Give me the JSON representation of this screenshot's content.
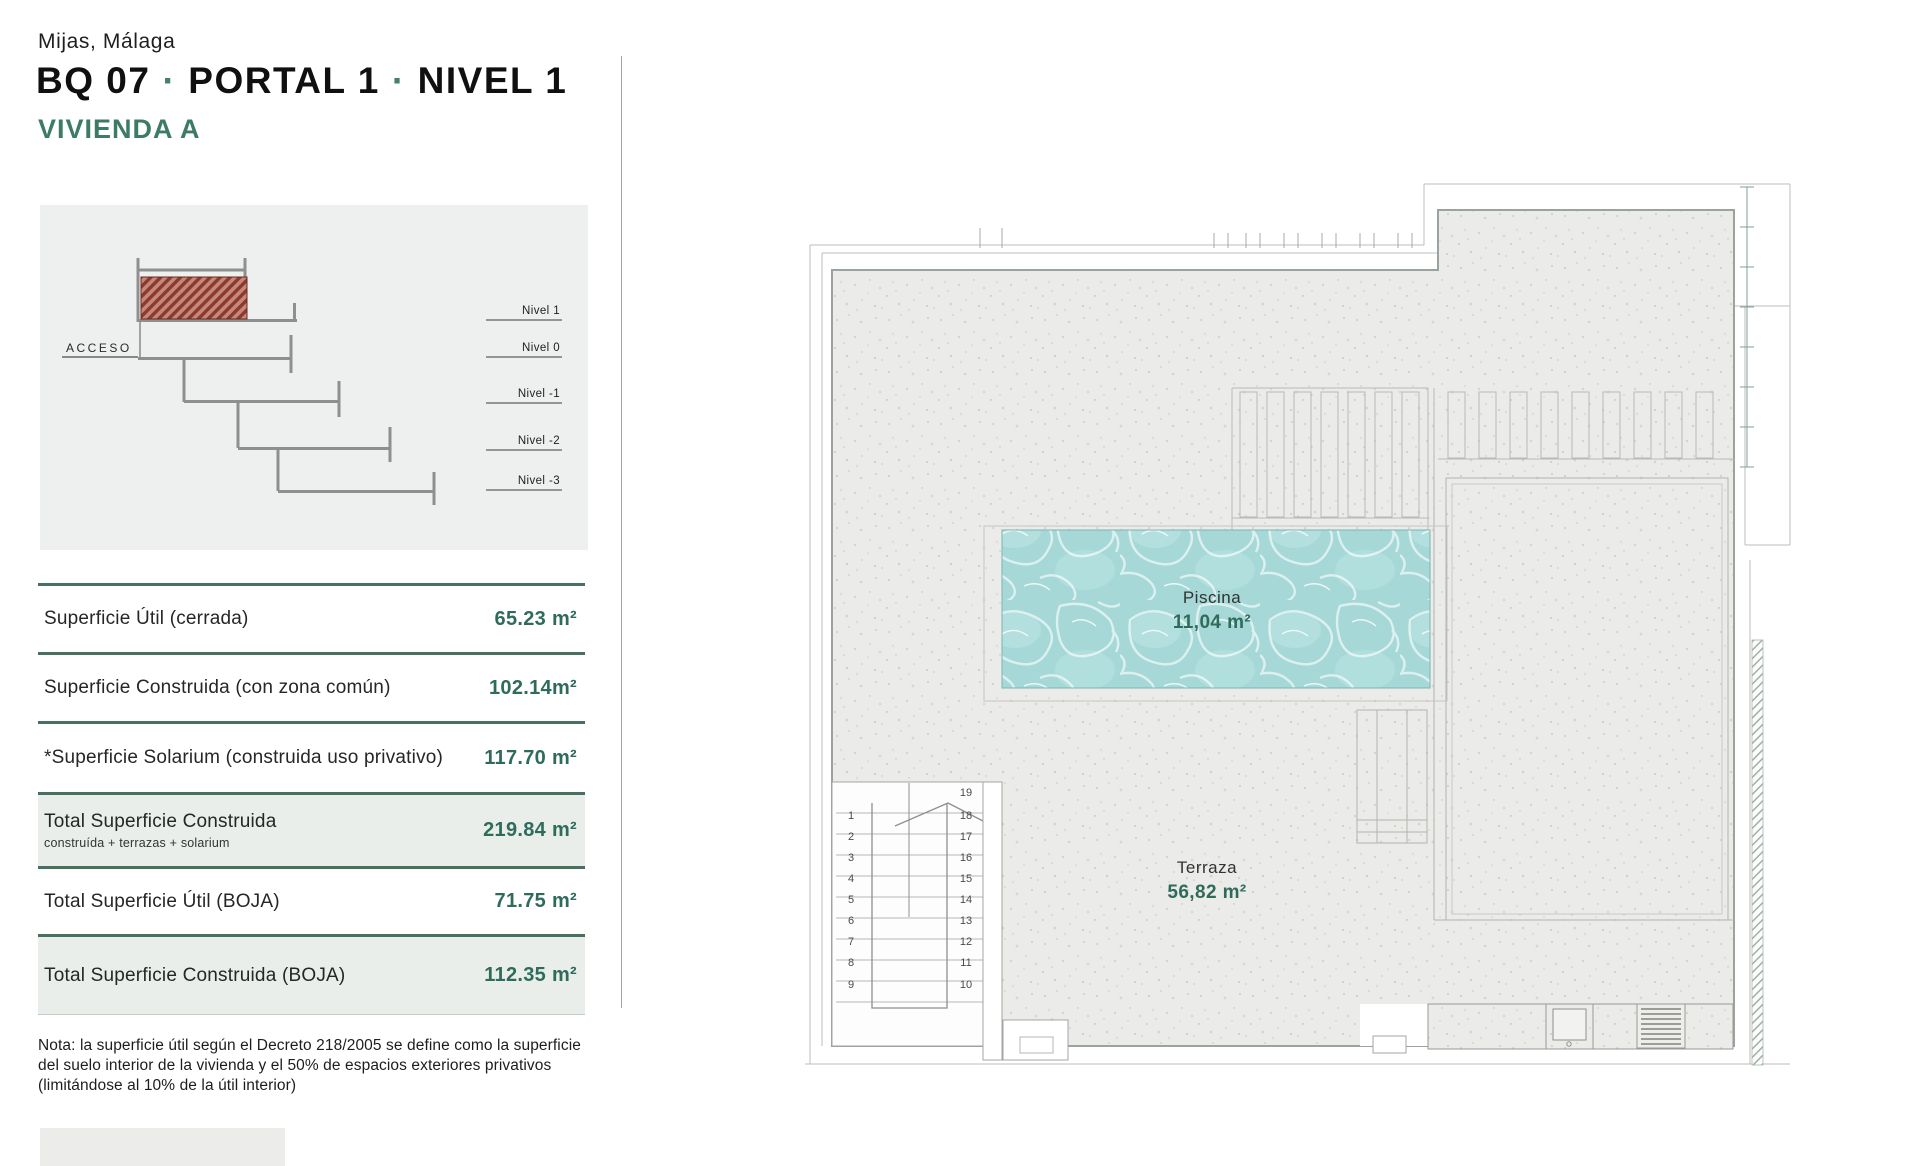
{
  "header": {
    "location": "Mijas, Málaga",
    "block": "BQ 07",
    "portal": "PORTAL 1",
    "level": "NIVEL 1",
    "separator": "·",
    "unit": "VIVIENDA A"
  },
  "section_diagram": {
    "access_label": "ACCESO",
    "levels": [
      "Nivel 1",
      "Nivel 0",
      "Nivel -1",
      "Nivel -2",
      "Nivel -3"
    ]
  },
  "areas_table": {
    "rows": [
      {
        "label": "Superficie Útil (cerrada)",
        "value": "65.23 m²"
      },
      {
        "label": "Superficie Construida (con zona común)",
        "value": "102.14m²"
      },
      {
        "label": "*Superficie Solarium (construida uso privativo)",
        "value": "117.70 m²"
      },
      {
        "label": "Total Superficie Construida",
        "sublabel": "construída + terrazas + solarium",
        "value": "219.84 m²"
      },
      {
        "label": "Total Superficie Útil (BOJA)",
        "value": "71.75 m²"
      },
      {
        "label": "Total Superficie Construida (BOJA)",
        "value": "112.35 m²"
      }
    ]
  },
  "note": "Nota: la superficie útil según el Decreto 218/2005 se define como la superficie del suelo interior de la vivienda y el 50% de espacios exteriores privativos (limitándose al 10% de la útil interior)",
  "plan": {
    "pool_label": "Piscina",
    "pool_area": "11,04 m²",
    "terrace_label": "Terraza",
    "terrace_area": "56,82 m²",
    "stair_numbers_left": [
      "1",
      "2",
      "3",
      "4",
      "5",
      "6",
      "7",
      "8",
      "9"
    ],
    "stair_numbers_right": [
      "19",
      "18",
      "17",
      "16",
      "15",
      "14",
      "13",
      "12",
      "11",
      "10"
    ]
  },
  "colors": {
    "accent_green": "#2f6b5b",
    "table_line_green": "#47705f",
    "row_tint": "#e9eeea",
    "panel_bg": "#eef0ef",
    "plan_concrete": "#ebebe9",
    "pool_water": "#a6d8d7",
    "highlight_hatch_red": "#8c3a2e"
  }
}
